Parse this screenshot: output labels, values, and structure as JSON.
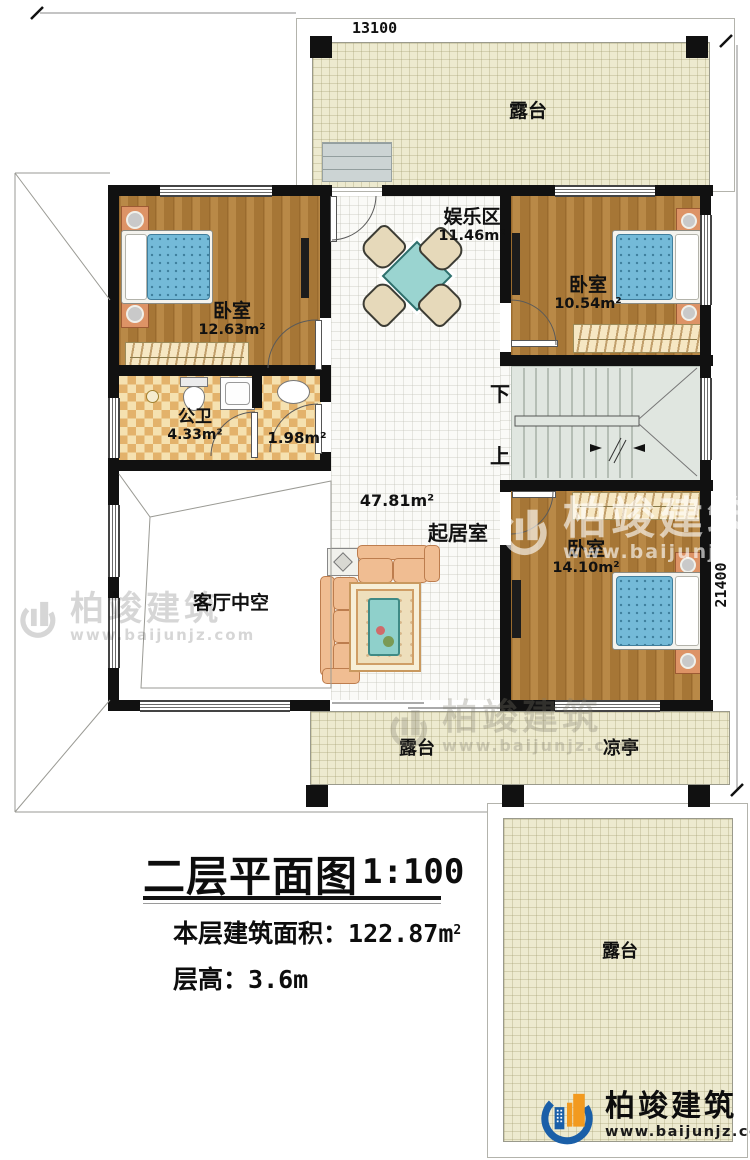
{
  "dims": {
    "top": "13100",
    "right": "21400"
  },
  "stairs": {
    "down": "下",
    "up": "上"
  },
  "rooms": {
    "terrace_top": {
      "name": "露台"
    },
    "entertainment": {
      "name": "娱乐区",
      "area": "11.46m²"
    },
    "bedroom_left": {
      "name": "卧室",
      "area": "12.63m²"
    },
    "bedroom_right": {
      "name": "卧室",
      "area": "10.54m²"
    },
    "bathroom": {
      "name": "公卫",
      "area": "4.33m²"
    },
    "washroom": {
      "area": "1.98m²"
    },
    "living": {
      "name": "起居室",
      "area": "47.81m²"
    },
    "void": {
      "name": "客厅中空"
    },
    "bedroom_bottom": {
      "name": "卧室",
      "area": "14.10m²"
    },
    "terrace_bottom": {
      "name": "露台"
    },
    "pavilion": {
      "name": "凉亭"
    },
    "terrace_br": {
      "name": "露台"
    }
  },
  "title": {
    "main": "二层平面图",
    "scale": "1:100",
    "area_label": "本层建筑面积：",
    "area_value": "122.87m",
    "area_sup": "2",
    "height_label": "层高：",
    "height_value": "3.6m"
  },
  "brand": {
    "name": "柏竣建筑",
    "url": "www.baijunjz.com",
    "blue": "#1a5fa8",
    "orange": "#f29a1f"
  },
  "colors": {
    "wall": "#111111",
    "wood_floor": "#b5823c",
    "terrace_tile": "#edeacf",
    "bed_blue": "#74bad8",
    "table_teal": "#9ad4d0",
    "stair_gray": "#e0e6e0"
  }
}
